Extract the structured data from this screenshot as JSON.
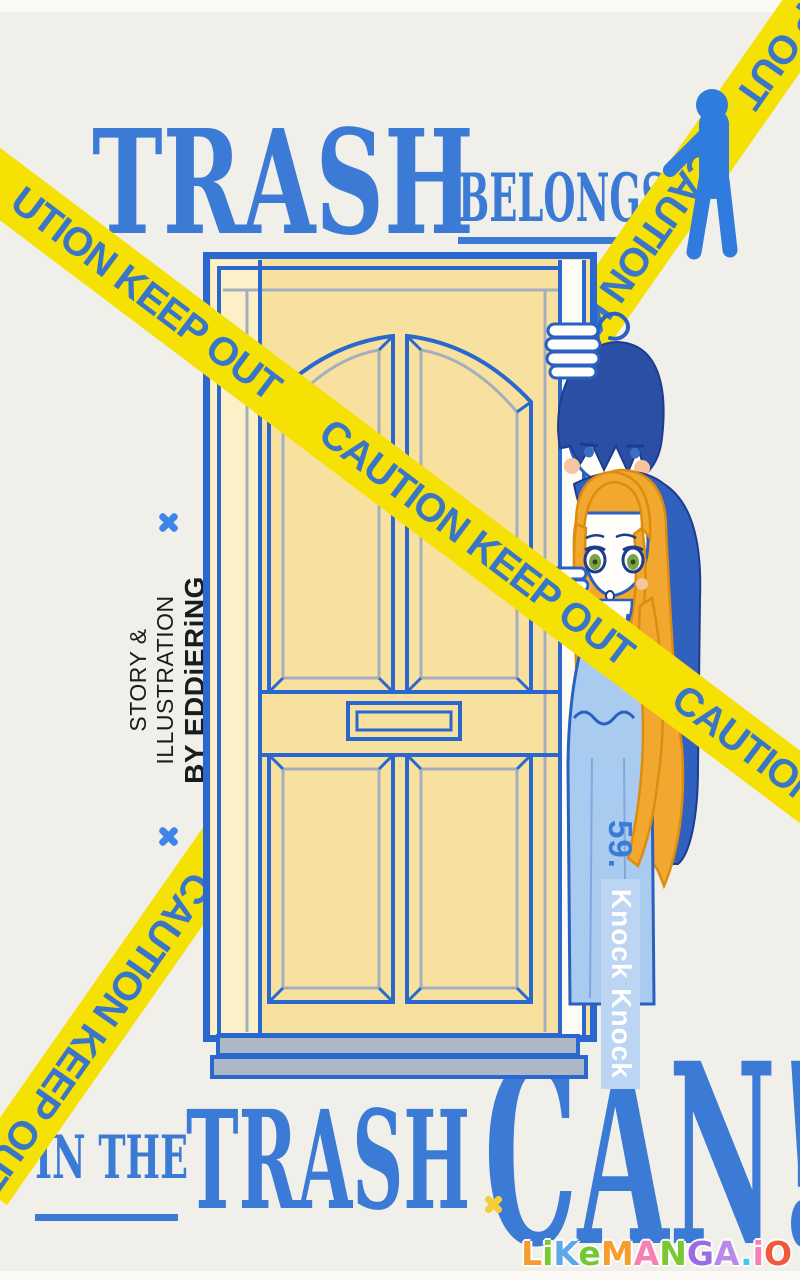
{
  "title_top": {
    "word1": "TRASH",
    "word2": "BELONGS"
  },
  "title_bottom": {
    "word1": "IN THE",
    "word2": "TRASH",
    "word3": "CAN!"
  },
  "tape": {
    "text": "CAUTION KEEP OUT",
    "band_a": "UTION KEEP OUT      CAUTION KEEP OUT      CAUTION KEEP OUT      CAUTION KEEP OUT",
    "band_b": "CAUTION KEEP OUT      CAUTION KEEP OUT      CAUTION KEEP OUT      CAUTION KEEP OUT"
  },
  "credit": {
    "line1": "STORY & ILLUSTRATION",
    "line2": "BY EDDiERiNG"
  },
  "chapter": {
    "number": "59.",
    "title": "Knock Knock"
  },
  "watermark": {
    "letters": [
      {
        "ch": "L",
        "color": "#F59D2E"
      },
      {
        "ch": "i",
        "color": "#7CC832"
      },
      {
        "ch": "K",
        "color": "#5FA8E8"
      },
      {
        "ch": "e",
        "color": "#72C932"
      },
      {
        "ch": "M",
        "color": "#F59D2E"
      },
      {
        "ch": "A",
        "color": "#F780B2"
      },
      {
        "ch": "N",
        "color": "#7CC832"
      },
      {
        "ch": "G",
        "color": "#9B6BE0"
      },
      {
        "ch": "A",
        "color": "#B98BE8"
      },
      {
        "ch": ".",
        "color": "#3FC8E8"
      },
      {
        "ch": "i",
        "color": "#F780B2"
      },
      {
        "ch": "O",
        "color": "#F0593C"
      }
    ]
  },
  "colors": {
    "background": "#F1EFE9",
    "title_blue": "#3B7BD5",
    "tape_yellow": "#F6E104",
    "tape_text_blue": "#3A76C8",
    "door_yellow": "#F8E19E",
    "door_line_blue": "#2A67CE",
    "threshold_gray": "#ACB8C6",
    "boy_hair_navy": "#2C4FA6",
    "girl_hair_gold": "#F2A72E",
    "dress_blue": "#A9CBEF",
    "chapter_band_blue": "#BCD5F2",
    "credit_black": "#1B1B1B",
    "x_mark_blue": "#3D85E8"
  }
}
